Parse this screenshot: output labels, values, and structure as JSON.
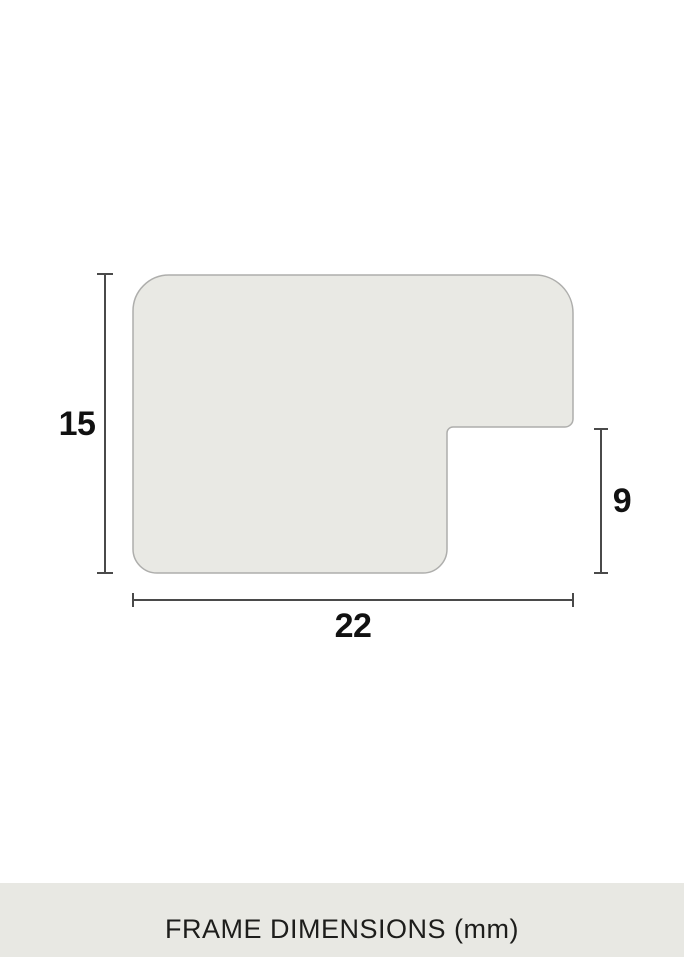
{
  "diagram": {
    "caption": "FRAME DIMENSIONS (mm)",
    "unit": "mm",
    "labels": {
      "height": "15",
      "rabbet_depth": "9",
      "width": "22"
    }
  },
  "colors": {
    "background": "#ffffff",
    "profile_fill": "#e9e9e4",
    "profile_stroke": "#aeaeac",
    "dimension_line": "#4a4a4a",
    "label_text": "#111111",
    "caption_bar_bg": "#e8e8e3",
    "caption_text": "#1d1d1b"
  }
}
